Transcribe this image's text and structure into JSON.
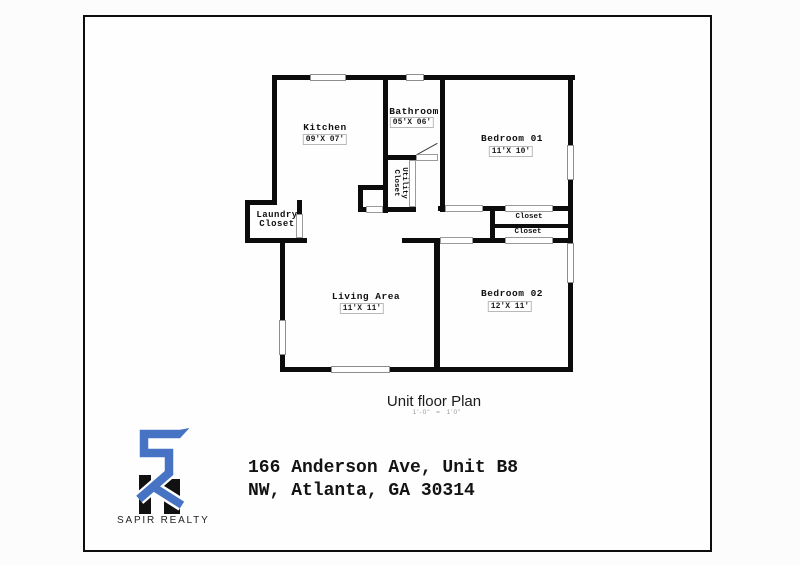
{
  "plan": {
    "rooms": {
      "kitchen": {
        "name": "Kitchen",
        "dims": "09'X 07'"
      },
      "bathroom": {
        "name": "Bathroom",
        "dims": "05'X 06'"
      },
      "bedroom1": {
        "name": "Bedroom 01",
        "dims": "11'X 10'"
      },
      "living": {
        "name": "Living Area",
        "dims": "11'X 11'"
      },
      "bedroom2": {
        "name": "Bedroom 02",
        "dims": "12'X 11'"
      }
    },
    "labels": {
      "laundry_line1": "Laundry",
      "laundry_line2": "Closet",
      "utility_line1": "Utility",
      "utility_line2": "Closet",
      "closet_top": "Closet",
      "closet_bottom": "Closet"
    }
  },
  "caption": {
    "title": "Unit floor Plan",
    "scale": "1'-0\"  =  1'0\""
  },
  "branding": {
    "name": "SAPIR REALTY",
    "accent_blue": "#4673c4",
    "bar_black": "#111111"
  },
  "address": {
    "line1": "166 Anderson Ave, Unit B8",
    "line2": "NW, Atlanta, GA 30314"
  }
}
